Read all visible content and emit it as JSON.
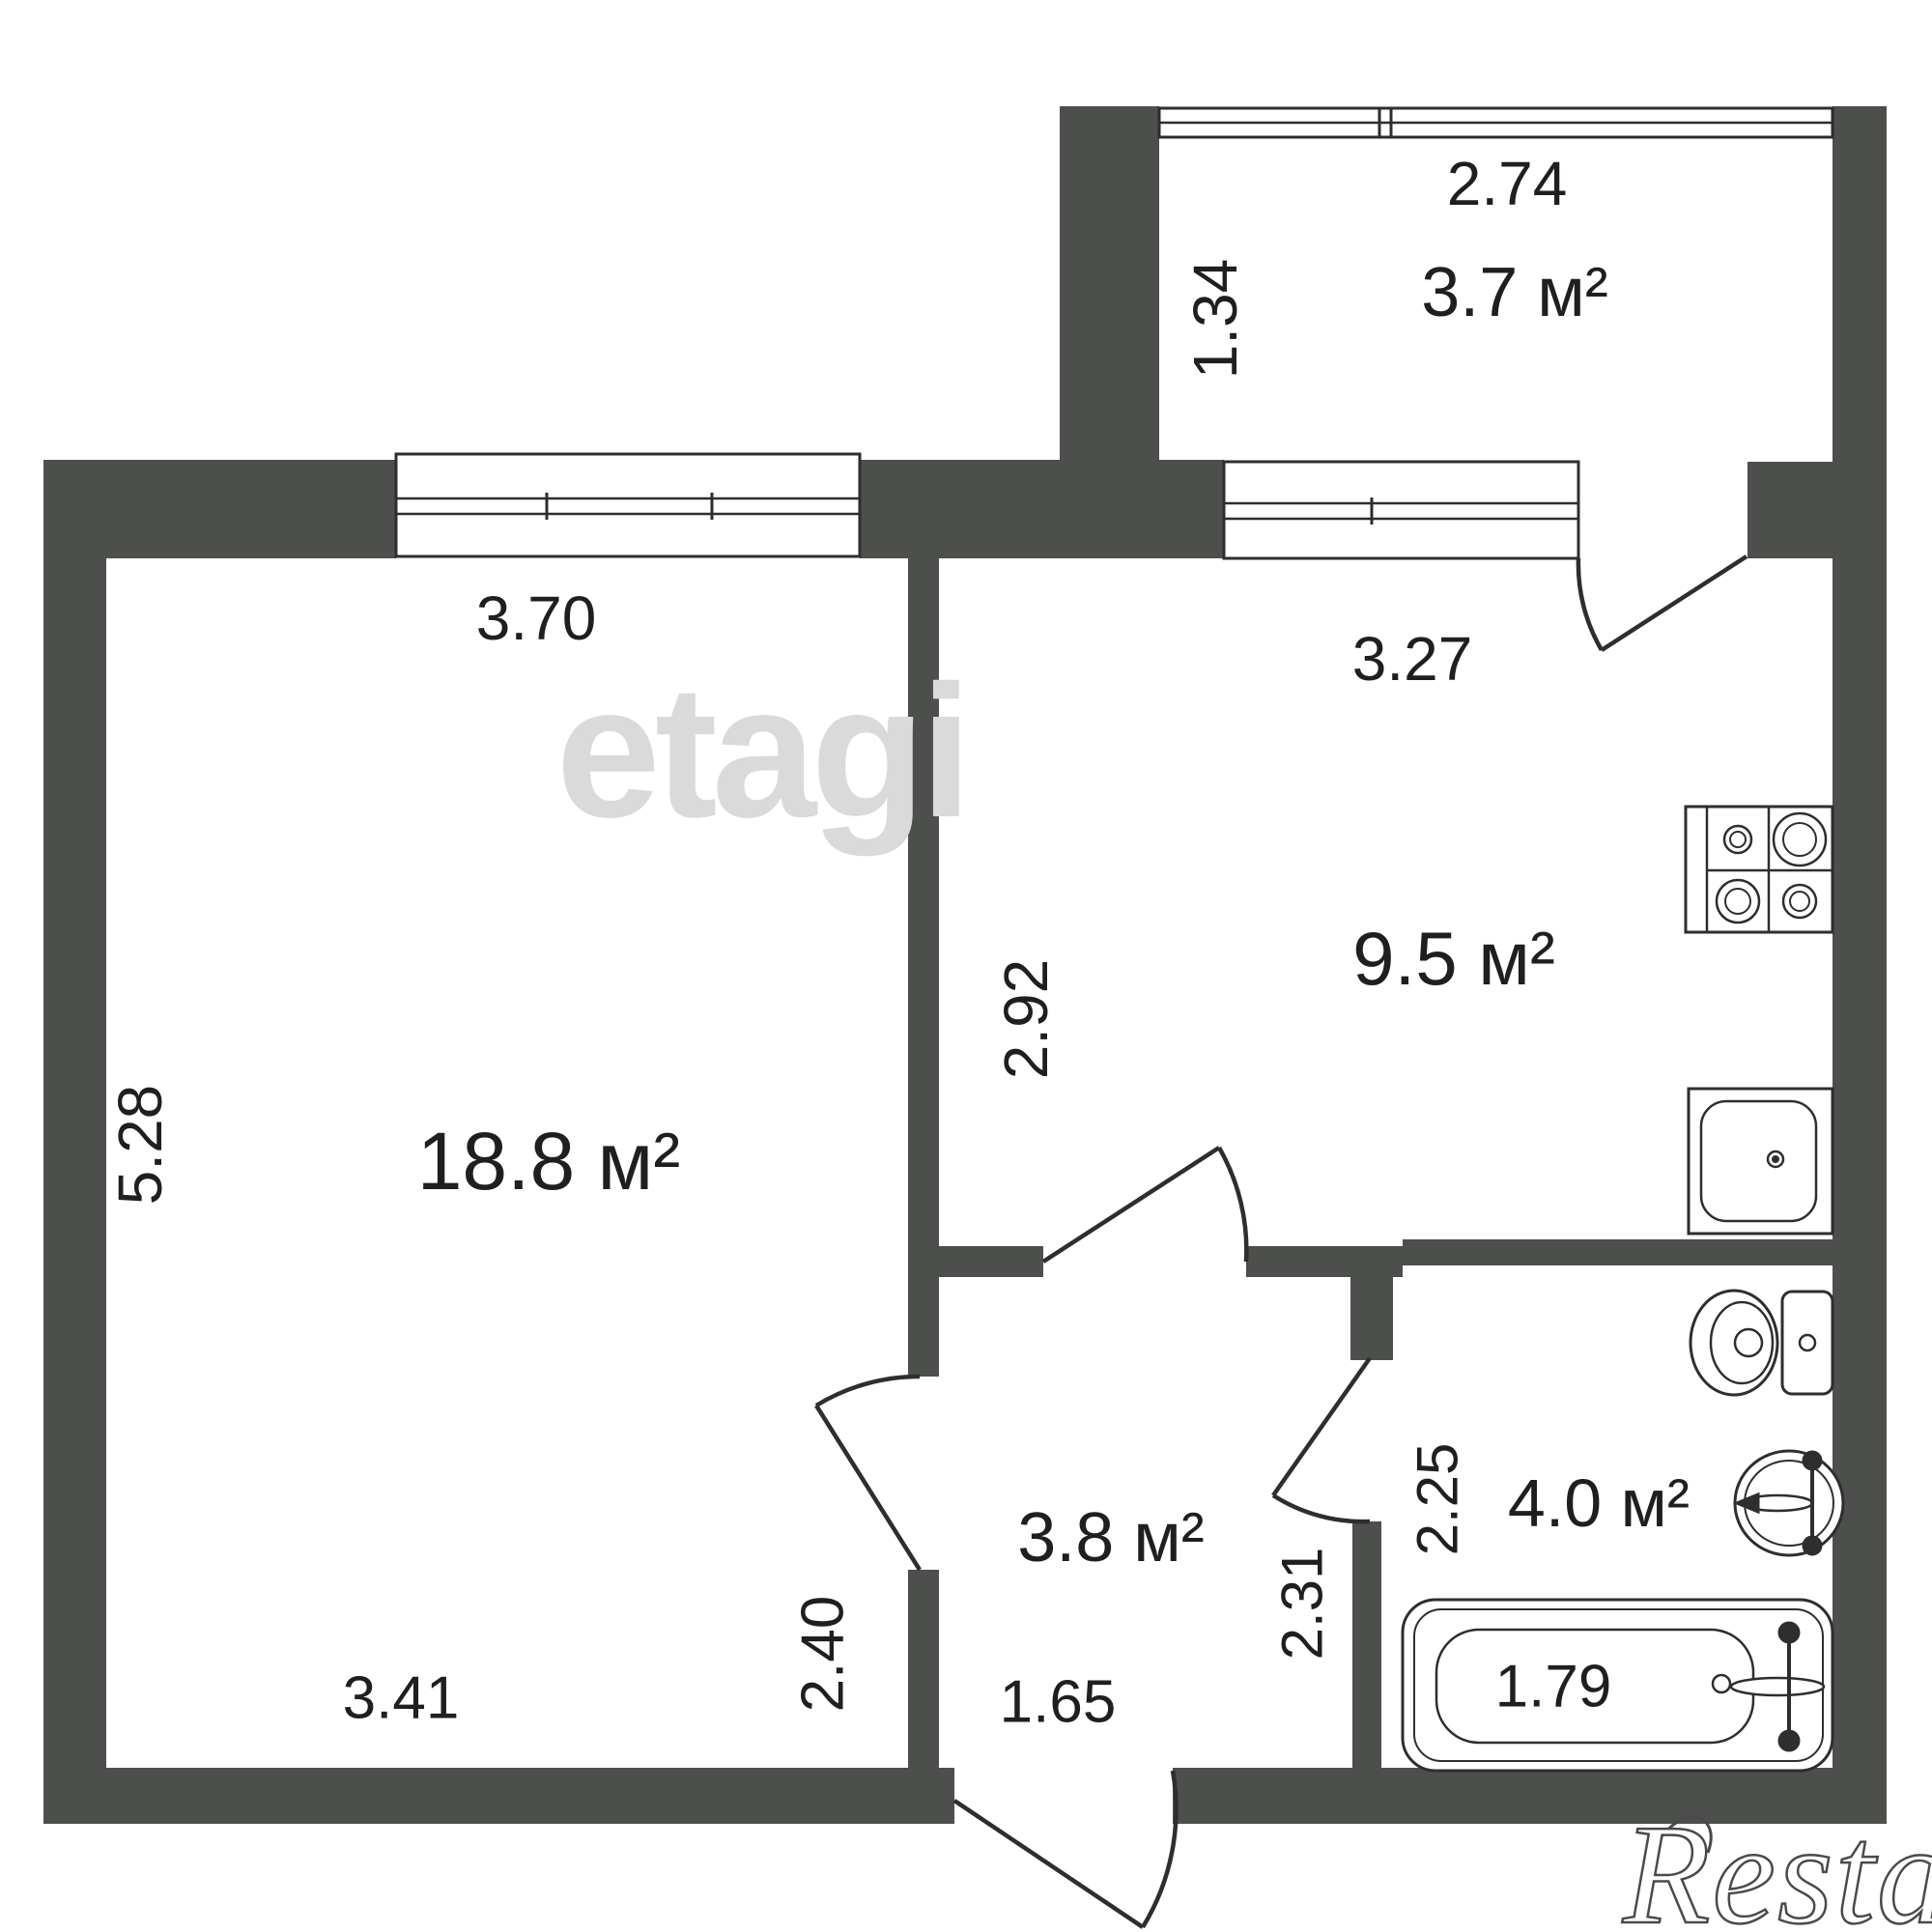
{
  "colors": {
    "wall": "#4d4f4c",
    "line": "#2e2e2e",
    "text": "#1f1f1f",
    "watermark_center": "#dadada",
    "watermark_corner_outline": "#4a4a4a"
  },
  "watermarks": {
    "brand_center": "etagi",
    "brand_corner": "Restate"
  },
  "rooms": {
    "living": {
      "area": "18.8 м²",
      "window_width": "3.70",
      "width": "3.41",
      "height": "5.28",
      "door_wall": "2.40"
    },
    "kitchen": {
      "area": "9.5 м²",
      "window_width": "3.27",
      "depth": "2.92"
    },
    "balcony": {
      "area": "3.7 м²",
      "width": "2.74",
      "depth": "1.34"
    },
    "hallway": {
      "area": "3.8 м²",
      "width": "1.65",
      "bathroom_wall": "2.31"
    },
    "bathroom": {
      "area": "4.0 м²",
      "depth": "2.25",
      "bathtub_length": "1.79"
    }
  }
}
